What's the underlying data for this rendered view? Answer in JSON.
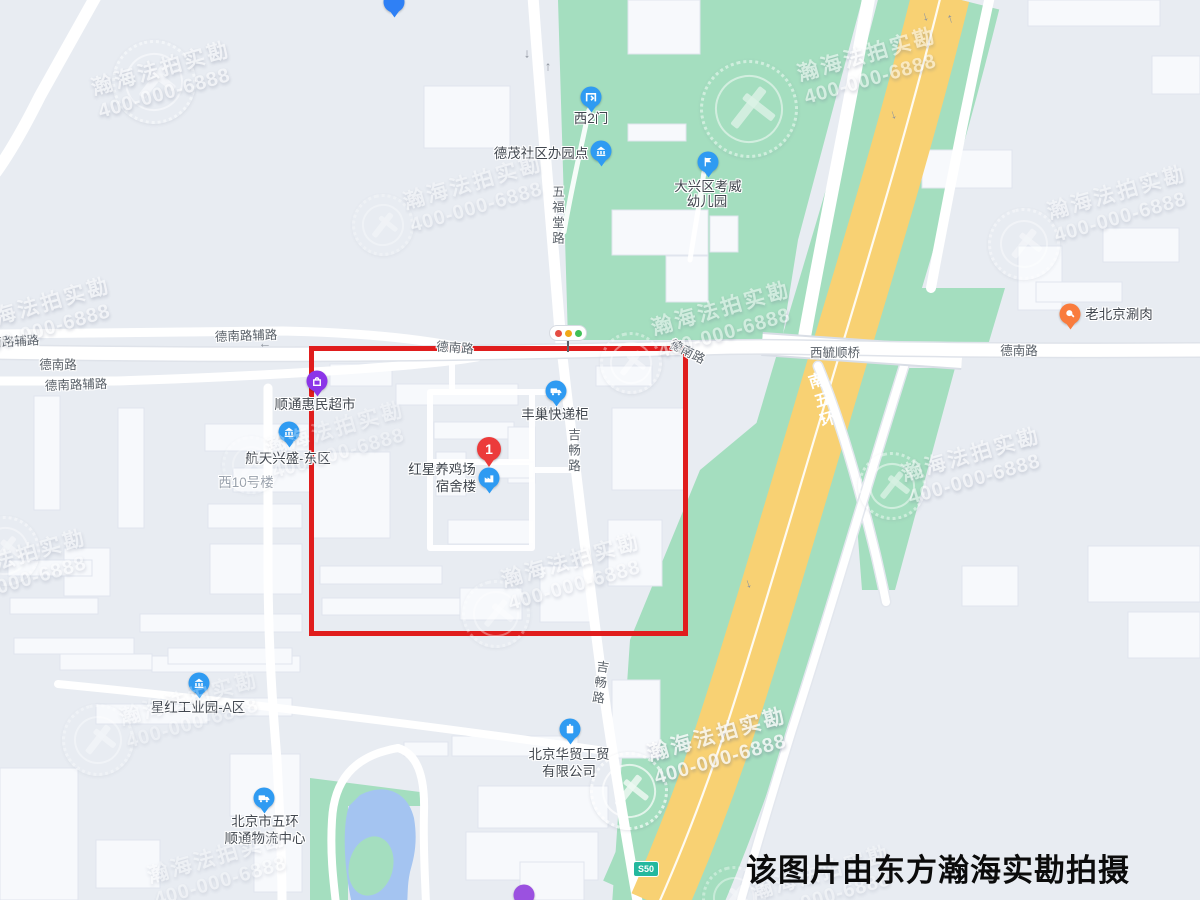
{
  "watermark": {
    "brand": "瀚海法拍实勘",
    "phone": "400-000-6888"
  },
  "caption": "该图片由东方瀚海实勘拍摄",
  "road_badge": "S50",
  "main_marker": {
    "number": "1",
    "line1": "红星养鸡场",
    "line2": "宿舍楼"
  },
  "pois": {
    "west_gate2": "西2门",
    "demao": "德茂社区办园点",
    "kindergarten1": "大兴区考威",
    "kindergarten2": "幼儿园",
    "shuanrou": "老北京涮肉",
    "supermarket": "顺通惠民超市",
    "fengchao": "丰巢快递柜",
    "hangtian": "航天兴盛-东区",
    "xi10": "西10号楼",
    "xinghong": "星红工业园-A区",
    "huamao1": "北京华贸工贸",
    "huamao2": "有限公司",
    "wuhuan1": "北京市五环",
    "wuhuan2": "顺通物流中心"
  },
  "roads": {
    "denan": "德南路",
    "denan_fulu": "德南路辅路",
    "wufutang": "五福堂路",
    "jichang": "吉畅路",
    "xiyushun_bridge": "西毓顺桥",
    "nanwuhuan": "南五环"
  },
  "glyphs": {
    "up": "↑",
    "down": "↓",
    "left": "←"
  },
  "colors": {
    "background": "#e8ecf2",
    "building": "#f7f9fc",
    "green": "#a4debf",
    "highway_yellow": "#f8d173",
    "water": "#a4c4f1",
    "highlight_red": "#e01d1d",
    "poi_blue": "#2f9bf2",
    "poi_purple": "#8b35e8",
    "poi_orange": "#f97c3d",
    "marker_red": "#ec3b3b",
    "badge_green": "#24b89e"
  }
}
